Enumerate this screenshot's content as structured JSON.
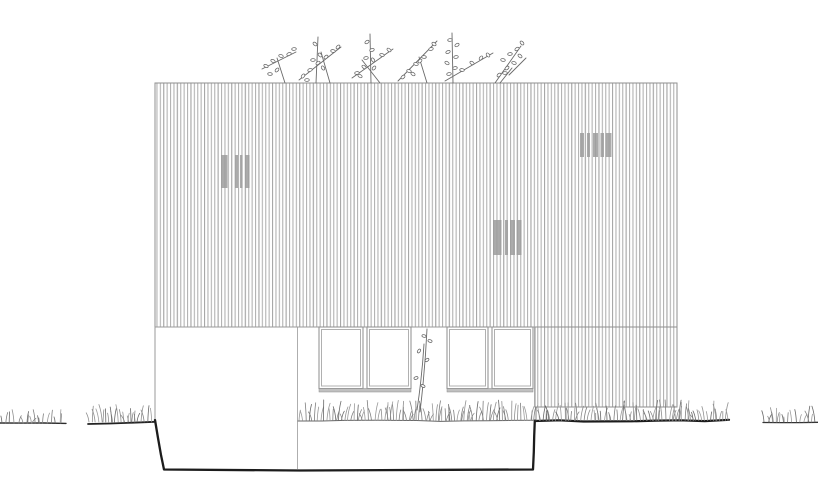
{
  "app": {
    "type": "architectural-elevation-drawing",
    "content": "house side elevation with vertical timber cladding, louvre vents, ribbon windows, grass and rooftop shrubs"
  },
  "canvas": {
    "width": 818,
    "height": 493
  },
  "palette": {
    "background": "#ffffff",
    "siding_line": "#b3b3b3",
    "panel_border": "#8f8f8f",
    "edge_light": "#9e9e9e",
    "vent_bar": "#9c9c9c",
    "window_frame": "#8d8d8d",
    "window_inner": "#b0b0b0",
    "window_sill": "#c0c0c0",
    "ground_dark": "#1c1c1c",
    "ground_mid": "#2e2e2e",
    "ground_thin": "#666666",
    "grass_tones": [
      "#9a9a9a",
      "#7f7f7f",
      "#686868",
      "#8f8f8f"
    ],
    "plant": "#6a6a6a"
  },
  "cladding": {
    "stripe_period": 3.4,
    "stripe_width": 1.1,
    "panels": [
      {
        "name": "upper-cladding-panel",
        "x": 155,
        "y": 83,
        "w": 522,
        "h": 244
      },
      {
        "name": "right-cladding-panel",
        "x": 535,
        "y": 327,
        "w": 142,
        "h": 80
      }
    ]
  },
  "wall_edges": [
    {
      "name": "lower-wall-left-edge",
      "x1": 155,
      "y1": 327,
      "x2": 155,
      "y2": 420,
      "w": 1,
      "color": "#9a9a9a"
    },
    {
      "name": "lower-wall-divider",
      "x1": 297.5,
      "y1": 327,
      "x2": 297.5,
      "y2": 469,
      "w": 0.8,
      "color": "#9a9a9a"
    },
    {
      "name": "lower-wall-right-joint",
      "x1": 534.5,
      "y1": 327,
      "x2": 534.5,
      "y2": 407,
      "w": 0.8,
      "color": "#a6a6a6"
    },
    {
      "name": "cladding-bottom-seam",
      "x1": 155,
      "y1": 327,
      "x2": 535,
      "y2": 327,
      "w": 1,
      "color": "#9a9a9a"
    }
  ],
  "vents": [
    {
      "name": "louvre-vent-left",
      "x": 221,
      "y": 155,
      "h": 33,
      "bars": [
        {
          "dx": 0,
          "w": 6.5
        },
        {
          "dx": 14,
          "w": 3
        },
        {
          "dx": 19,
          "w": 2.5
        },
        {
          "dx": 24,
          "w": 4.5
        }
      ]
    },
    {
      "name": "louvre-vent-right",
      "x": 580,
      "y": 133,
      "h": 24,
      "bars": [
        {
          "dx": 0,
          "w": 4
        },
        {
          "dx": 7,
          "w": 3
        },
        {
          "dx": 13,
          "w": 5
        },
        {
          "dx": 20.5,
          "w": 3.5
        },
        {
          "dx": 25.5,
          "w": 6
        }
      ]
    },
    {
      "name": "louvre-vent-center",
      "x": 493,
      "y": 220,
      "h": 35,
      "bars": [
        {
          "dx": 0,
          "w": 8.5
        },
        {
          "dx": 12,
          "w": 3
        },
        {
          "dx": 17,
          "w": 5
        },
        {
          "dx": 23.5,
          "w": 5
        }
      ]
    }
  ],
  "windows": [
    {
      "name": "window-group-left",
      "x": 319,
      "y": 327,
      "w": 92,
      "h": 65,
      "sill_h": 3.5,
      "panes": [
        {
          "x": 319,
          "w": 44
        },
        {
          "x": 367,
          "w": 44
        }
      ]
    },
    {
      "name": "window-group-right",
      "x": 447,
      "y": 327,
      "w": 86,
      "h": 65,
      "sill_h": 3.5,
      "panes": [
        {
          "x": 447,
          "w": 41
        },
        {
          "x": 492,
          "w": 41
        }
      ]
    }
  ],
  "foundation": {
    "name": "foundation-outline",
    "points": [
      [
        155,
        420
      ],
      [
        158,
        438
      ],
      [
        161,
        455
      ],
      [
        164,
        469.5
      ],
      [
        300,
        470.5
      ],
      [
        450,
        469.8
      ],
      [
        533,
        469.5
      ],
      [
        533.8,
        452
      ],
      [
        534.2,
        436
      ],
      [
        534.8,
        420.5
      ]
    ],
    "w": 2.3
  },
  "ground_lines": [
    {
      "name": "ground-line-far-left",
      "x1": 0,
      "y1": 423,
      "x2": 66,
      "y2": 423,
      "w": 1.4,
      "color": "#2c2c2c",
      "amp": 0.5
    },
    {
      "name": "ground-line-left",
      "x1": 88,
      "y1": 424,
      "x2": 155,
      "y2": 421.5,
      "w": 1.8,
      "color": "#222222",
      "amp": 0.8
    },
    {
      "name": "ground-line-mid",
      "x1": 298,
      "y1": 421,
      "x2": 535,
      "y2": 420.5,
      "w": 1,
      "color": "#666666",
      "amp": 0.7
    },
    {
      "name": "ground-line-right",
      "x1": 535,
      "y1": 421,
      "x2": 729,
      "y2": 420.5,
      "w": 2.2,
      "color": "#1c1c1c",
      "amp": 0.8
    },
    {
      "name": "ground-line-far-right",
      "x1": 763,
      "y1": 422.5,
      "x2": 818,
      "y2": 422,
      "w": 1.3,
      "color": "#333333",
      "amp": 0.5
    }
  ],
  "grass_segments": [
    {
      "name": "grass-far-left",
      "x1": 2,
      "x2": 64,
      "y": 423,
      "step": 3.4,
      "hmin": 6,
      "hmax": 15
    },
    {
      "name": "grass-left",
      "x1": 89,
      "x2": 154,
      "y": 422,
      "step": 2.6,
      "hmin": 8,
      "hmax": 18
    },
    {
      "name": "grass-mid",
      "x1": 299,
      "x2": 534,
      "y": 420.5,
      "step": 2.4,
      "hmin": 8,
      "hmax": 21
    },
    {
      "name": "grass-right",
      "x1": 536,
      "x2": 728,
      "y": 420.5,
      "step": 2.4,
      "hmin": 8,
      "hmax": 21
    },
    {
      "name": "grass-far-right",
      "x1": 764,
      "x2": 816,
      "y": 422,
      "step": 3.2,
      "hmin": 7,
      "hmax": 16
    }
  ],
  "roof_plants": {
    "name": "roof-shrubs",
    "clumps": [
      {
        "stems": [
          [
            262,
            69,
            296,
            52
          ],
          [
            285,
            83,
            277,
            58
          ]
        ],
        "leaves": [
          [
            266,
            66
          ],
          [
            273,
            61
          ],
          [
            281,
            56
          ],
          [
            289,
            54
          ],
          [
            294,
            49
          ],
          [
            277,
            70
          ],
          [
            270,
            74
          ]
        ]
      },
      {
        "stems": [
          [
            299,
            80,
            341,
            47
          ],
          [
            316,
            83,
            318,
            37
          ],
          [
            330,
            83,
            321,
            52
          ]
        ],
        "leaves": [
          [
            303,
            76
          ],
          [
            310,
            70
          ],
          [
            318,
            63
          ],
          [
            326,
            57
          ],
          [
            333,
            51
          ],
          [
            338,
            47
          ],
          [
            315,
            44
          ],
          [
            320,
            55
          ],
          [
            313,
            60
          ],
          [
            323,
            68
          ],
          [
            307,
            80
          ]
        ]
      },
      {
        "stems": [
          [
            352,
            78,
            393,
            49
          ],
          [
            371,
            83,
            370,
            34
          ],
          [
            380,
            83,
            362,
            60
          ]
        ],
        "leaves": [
          [
            357,
            73
          ],
          [
            364,
            67
          ],
          [
            373,
            60
          ],
          [
            382,
            55
          ],
          [
            389,
            50
          ],
          [
            367,
            42
          ],
          [
            372,
            50
          ],
          [
            366,
            58
          ],
          [
            374,
            68
          ],
          [
            360,
            76
          ]
        ]
      },
      {
        "stems": [
          [
            398,
            81,
            437,
            41
          ],
          [
            427,
            83,
            419,
            57
          ]
        ],
        "leaves": [
          [
            403,
            77
          ],
          [
            409,
            71
          ],
          [
            416,
            64
          ],
          [
            424,
            57
          ],
          [
            431,
            49
          ],
          [
            434,
            44
          ],
          [
            420,
            61
          ],
          [
            413,
            74
          ]
        ]
      },
      {
        "stems": [
          [
            453,
            83,
            452,
            33
          ],
          [
            445,
            81,
            493,
            53
          ]
        ],
        "leaves": [
          [
            450,
            40
          ],
          [
            457,
            45
          ],
          [
            448,
            52
          ],
          [
            456,
            57
          ],
          [
            447,
            63
          ],
          [
            455,
            68
          ],
          [
            449,
            74
          ],
          [
            462,
            70
          ],
          [
            472,
            63
          ],
          [
            481,
            58
          ],
          [
            488,
            55
          ]
        ]
      },
      {
        "stems": [
          [
            495,
            83,
            521,
            46
          ],
          [
            509,
            75,
            526,
            58
          ],
          [
            500,
            83,
            512,
            68
          ]
        ],
        "leaves": [
          [
            503,
            60
          ],
          [
            510,
            54
          ],
          [
            517,
            49
          ],
          [
            522,
            43
          ],
          [
            507,
            68
          ],
          [
            514,
            63
          ],
          [
            520,
            56
          ],
          [
            499,
            75
          ],
          [
            505,
            73
          ]
        ]
      }
    ]
  },
  "sapling": {
    "name": "sapling-plant",
    "stems": [
      [
        427,
        329,
        420,
        412
      ],
      [
        424,
        344,
        417,
        410
      ]
    ],
    "leaves": [
      [
        424,
        336
      ],
      [
        430,
        341
      ],
      [
        419,
        351
      ],
      [
        427,
        360
      ],
      [
        416,
        378
      ],
      [
        423,
        386
      ]
    ]
  }
}
